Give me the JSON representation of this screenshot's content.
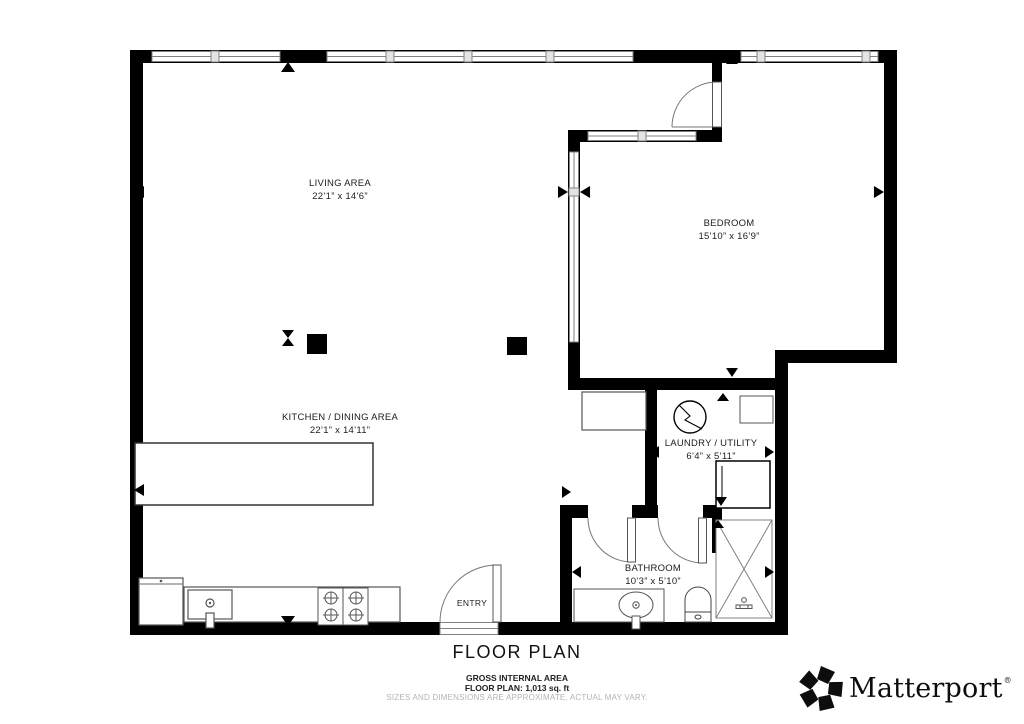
{
  "plan": {
    "title": "FLOOR PLAN",
    "footer": {
      "gross_area_label": "GROSS INTERNAL AREA",
      "floor_area": "FLOOR PLAN: 1,013 sq. ft",
      "disclaimer": "SIZES AND DIMENSIONS ARE APPROXIMATE, ACTUAL MAY VARY."
    }
  },
  "rooms": [
    {
      "name": "LIVING AREA",
      "dimensions": "22’1” x 14’6”"
    },
    {
      "name": "BEDROOM",
      "dimensions": "15’10” x 16’9”"
    },
    {
      "name": "KITCHEN / DINING AREA",
      "dimensions": "22’1” x 14’11”"
    },
    {
      "name": "LAUNDRY / UTILITY",
      "dimensions": "6’4” x 5’11”"
    },
    {
      "name": "BATHROOM",
      "dimensions": "10’3” x 5’10”"
    },
    {
      "name": "ENTRY",
      "dimensions": ""
    }
  ],
  "brand": {
    "name": "Matterport",
    "registered_mark": "®"
  },
  "colors": {
    "wall": "#000000",
    "fixture_stroke": "#555555",
    "window_stroke": "#808080",
    "disclaimer_text": "#b4b4b4"
  },
  "fixtures": [
    "refrigerator",
    "kitchen-sink",
    "cooktop",
    "kitchen-counter",
    "kitchen-island",
    "cabinet",
    "column",
    "washer",
    "dryer",
    "laundry-shelf",
    "vanity-sink",
    "toilet",
    "shower",
    "entry-door",
    "bedroom-door",
    "bathroom-door",
    "laundry-door",
    "window",
    "dimension-arrow"
  ]
}
